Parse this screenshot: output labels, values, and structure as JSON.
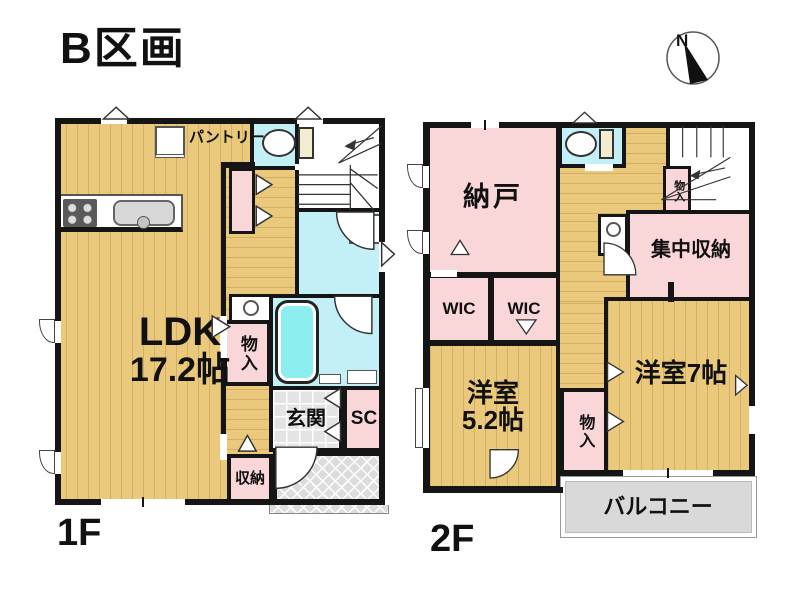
{
  "title": "B区画",
  "compass": {
    "north_label": "N"
  },
  "colors": {
    "wall": "#151515",
    "wood_floor": "#eac97c",
    "pink_room": "#f9d6d8",
    "cyan_room": "#c3eff6",
    "bathtub": "#8deef0",
    "entrance_tile": "#e4e4e4",
    "balcony_gray": "#d9d9d9",
    "porch_gray": "#dcdcdc"
  },
  "floor1": {
    "floor_label": "1F",
    "rooms": {
      "ldk_name": "LDK",
      "ldk_size": "17.2帖",
      "pantry": "パントリー",
      "closet": "物入",
      "entrance": "玄関",
      "shoe_closet": "SC",
      "storage": "収納"
    }
  },
  "floor2": {
    "floor_label": "2F",
    "rooms": {
      "storage_room": "納戸",
      "stair_closet": "物入",
      "central_storage": "集中収納",
      "wic_left": "WIC",
      "wic_right": "WIC",
      "west_room_small_name": "洋室",
      "west_room_small_size": "5.2帖",
      "closet_between": "物入",
      "west_room_large": "洋室7帖",
      "balcony": "バルコニー"
    }
  }
}
